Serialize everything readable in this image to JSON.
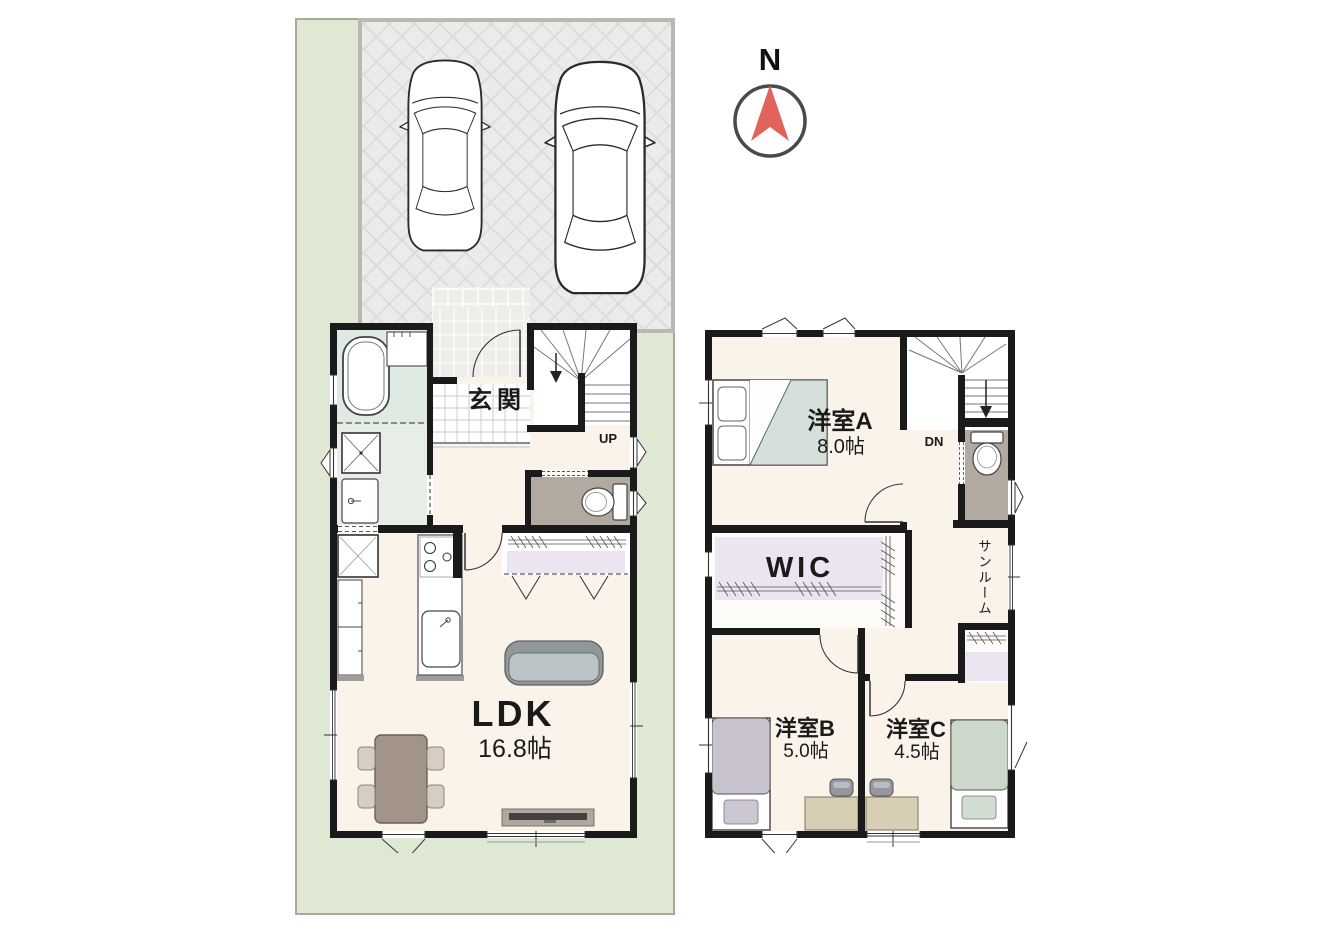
{
  "compass": {
    "north_label": "N"
  },
  "site_plan": {
    "cars_count": 2
  },
  "floor_1f": {
    "entrance_label": "玄関",
    "stairs_direction_label": "UP",
    "ldk_label": "LDK",
    "ldk_size": "16.8帖"
  },
  "floor_2f": {
    "stairs_direction_label": "DN",
    "room_a_label": "洋室A",
    "room_a_size": "8.0帖",
    "wic_label": "WIC",
    "sunroom_label": "サンルーム",
    "room_b_label": "洋室B",
    "room_b_size": "5.0帖",
    "room_c_label": "洋室C",
    "room_c_size": "4.5帖"
  },
  "colors": {
    "lot_green": "#dfe8d2",
    "parking_gray": "#ebebe9",
    "wall_black": "#1a1a1a",
    "floor_cream": "#faf3ea",
    "bath_green": "#dfeae3",
    "toilet_gray": "#b2a9a0",
    "closet_purple": "#ece4f1",
    "compass_red": "#e0635c"
  }
}
